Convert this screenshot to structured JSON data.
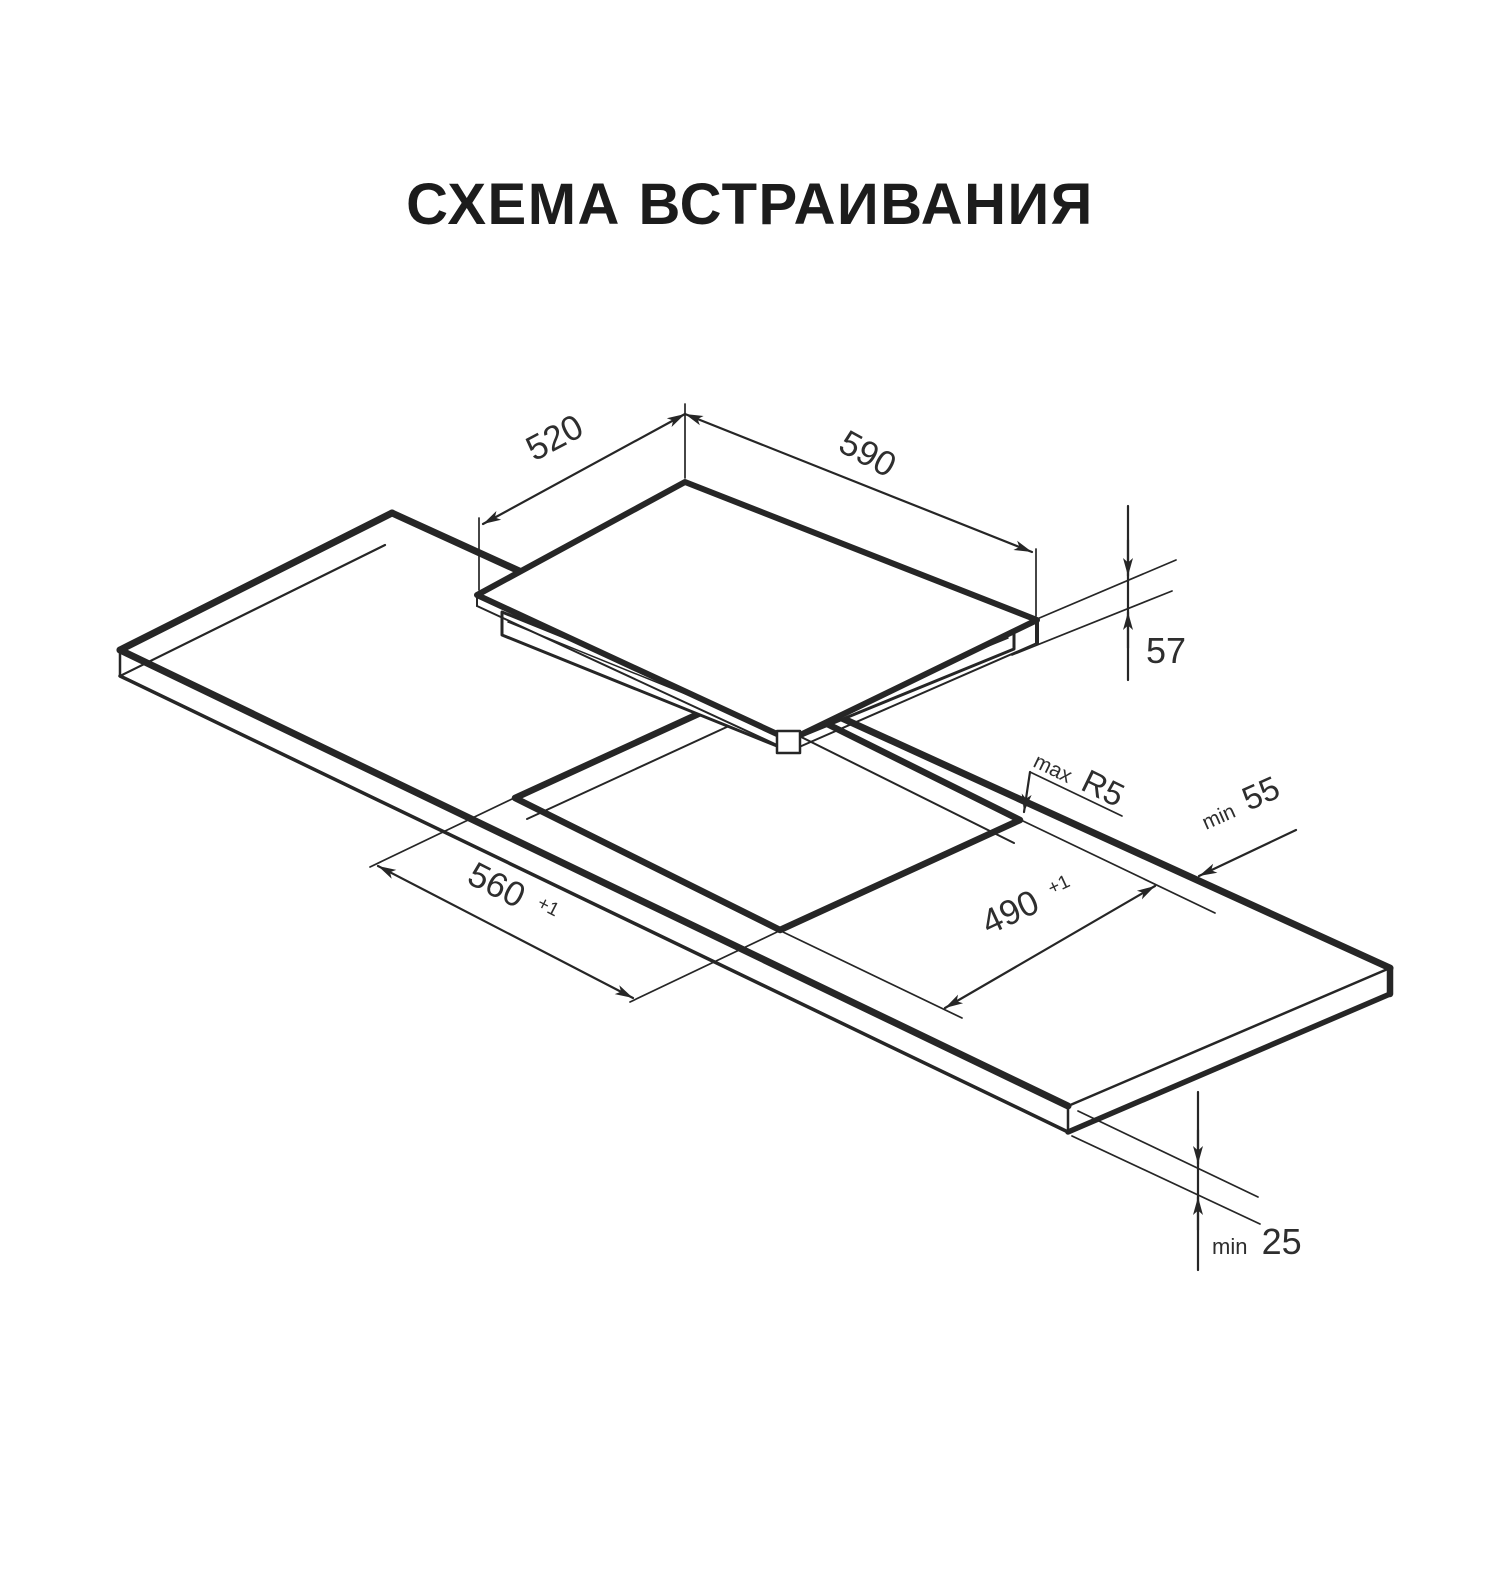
{
  "page": {
    "background": "#ffffff",
    "line_color": "#262626",
    "text_color": "#2e2e2e"
  },
  "title": "СХЕМА ВСТРАИВАНИЯ",
  "diagram": {
    "type": "isometric-built-in-hob-installation-scheme",
    "parts": [
      "worktop-slab",
      "worktop-cutout",
      "hob-panel"
    ],
    "dimensions": {
      "hob_top_depth": {
        "value": "520"
      },
      "hob_top_width": {
        "value": "590"
      },
      "hob_height": {
        "value": "57"
      },
      "cutout_corner_radius": {
        "prefix": "max",
        "value": "R5"
      },
      "rear_edge_clearance": {
        "prefix": "min",
        "value": "55"
      },
      "cutout_width": {
        "value": "560",
        "tolerance": "+1"
      },
      "cutout_depth": {
        "value": "490",
        "tolerance": "+1"
      },
      "worktop_thickness": {
        "prefix": "min",
        "value": "25"
      }
    }
  }
}
